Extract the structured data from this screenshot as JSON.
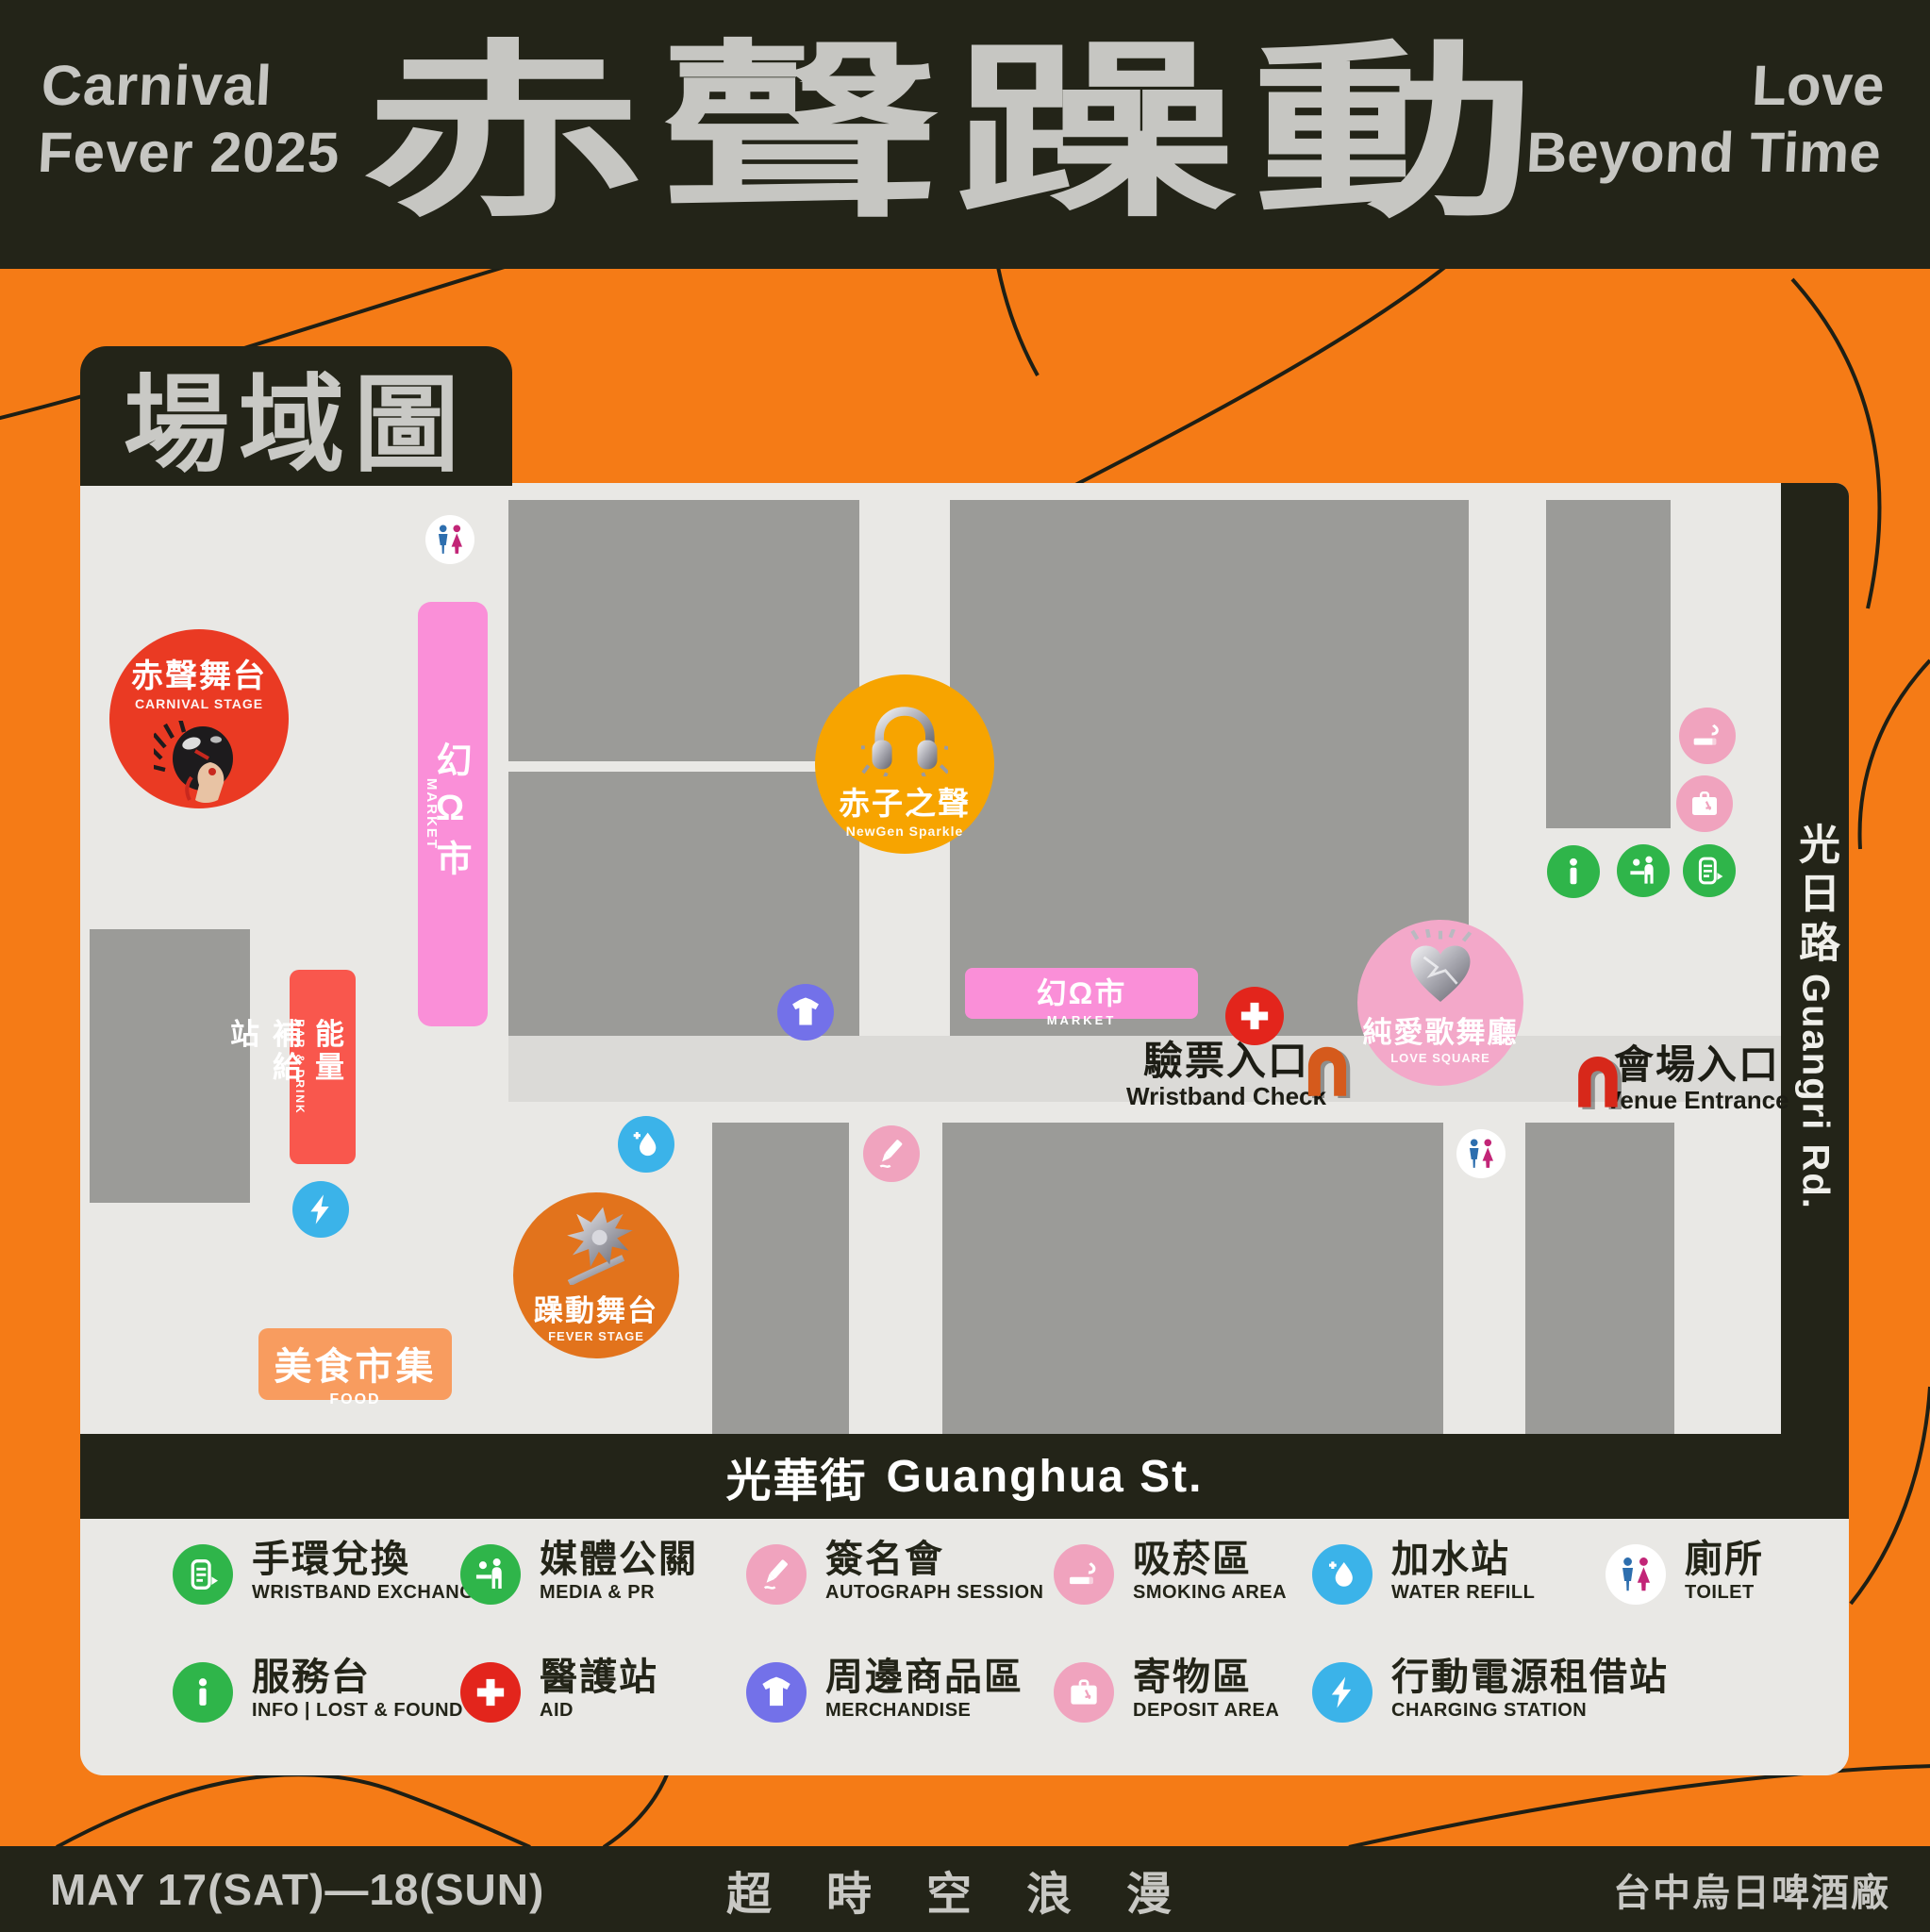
{
  "banner": {
    "left_line1": "Carnival",
    "left_line2": "Fever 2025",
    "title": "赤聲躁動",
    "right_line1": "Love",
    "right_line2": "Beyond Time"
  },
  "map": {
    "section_title": "場域圖",
    "roads": {
      "east": {
        "cjk": "光日路",
        "en": "Guangri Rd."
      },
      "south": {
        "cjk": "光華街",
        "en": "Guanghua St."
      }
    },
    "venues": {
      "carnival_stage": {
        "cjk": "赤聲舞台",
        "en": "CARNIVAL STAGE"
      },
      "newgen_sparkle": {
        "cjk": "赤子之聲",
        "en": "NewGen Sparkle"
      },
      "fever_stage": {
        "cjk": "躁動舞台",
        "en": "FEVER STAGE"
      },
      "love_square": {
        "cjk": "純愛歌舞廳",
        "en": "LOVE SQUARE"
      },
      "market_vertical": {
        "cjk": "幻Ω市",
        "en": "MARKET"
      },
      "market_horizontal": {
        "cjk": "幻Ω市",
        "en": "MARKET"
      },
      "bar_drink": {
        "cjk": "能量補給站",
        "en": "BAR & DRINK"
      },
      "food": {
        "cjk": "美食市集",
        "en": "FOOD"
      }
    },
    "entrances": {
      "wristband_check": {
        "cjk": "驗票入口",
        "en": "Wristband Check"
      },
      "venue_entrance": {
        "cjk": "會場入口",
        "en": "Venue Entrance"
      }
    },
    "poi_icons": [
      "toilet-icon",
      "market-toilet-icon",
      "merchandise-icon",
      "water-refill-icon",
      "autograph-icon",
      "charging-icon",
      "aid-icon",
      "smoking-icon",
      "deposit-icon",
      "info-icon",
      "media-icon",
      "wristband-icon",
      "entrance-arch-icon"
    ]
  },
  "legend": {
    "row1": [
      {
        "icon": "wristband-icon",
        "color": "#2FB54A",
        "cjk": "手環兌換",
        "en": "WRISTBAND EXCHANGE"
      },
      {
        "icon": "media-icon",
        "color": "#2FB54A",
        "cjk": "媒體公關",
        "en": "MEDIA & PR"
      },
      {
        "icon": "autograph-icon",
        "color": "#F0A3BE",
        "cjk": "簽名會",
        "en": "AUTOGRAPH SESSION"
      },
      {
        "icon": "smoking-icon",
        "color": "#F0A3BE",
        "cjk": "吸菸區",
        "en": "SMOKING AREA"
      },
      {
        "icon": "water-refill-icon",
        "color": "#3BB3E9",
        "cjk": "加水站",
        "en": "WATER REFILL"
      },
      {
        "icon": "toilet-icon",
        "color": "#FFFFFF",
        "cjk": "廁所",
        "en": "TOILET"
      }
    ],
    "row2": [
      {
        "icon": "info-icon",
        "color": "#2FB54A",
        "cjk": "服務台",
        "en": "INFO | LOST & FOUND"
      },
      {
        "icon": "aid-icon",
        "color": "#E3251C",
        "cjk": "醫護站",
        "en": "AID"
      },
      {
        "icon": "merchandise-icon",
        "color": "#7371E9",
        "cjk": "周邊商品區",
        "en": "MERCHANDISE"
      },
      {
        "icon": "deposit-icon",
        "color": "#F0A3BE",
        "cjk": "寄物區",
        "en": "DEPOSIT AREA"
      },
      {
        "icon": "charging-icon",
        "color": "#3BB3E9",
        "cjk": "行動電源租借站",
        "en": "CHARGING STATION"
      }
    ]
  },
  "footer": {
    "dates": "MAY 17(SAT)—18(SUN)",
    "slogan": "超時空浪漫",
    "venue": "台中烏日啤酒廠"
  },
  "colors": {
    "orange_bg": "#F57B16",
    "ink": "#232418",
    "map_bg": "#E9E8E5",
    "street": "#DBDAD7",
    "block_gray": "#9B9B98",
    "market_pink": "#FA8FD8",
    "icon_pink": "#F0A3BE",
    "love_pink": "#F3A8C9",
    "stage_red": "#EA3A23",
    "bar_red": "#F9574D",
    "aid_red": "#E3251C",
    "newgen_amber": "#F7A400",
    "fever_orange": "#E2731C",
    "food_orange": "#F89C5F",
    "green": "#2FB54A",
    "blue": "#3BB3E9",
    "purple": "#7371E9",
    "toilet_blue": "#2D6EAE",
    "toilet_magenta": "#C22577",
    "arch_orange": "#D55A1C",
    "arch_red": "#D7281A",
    "banner_text": "#C6C6C2"
  }
}
